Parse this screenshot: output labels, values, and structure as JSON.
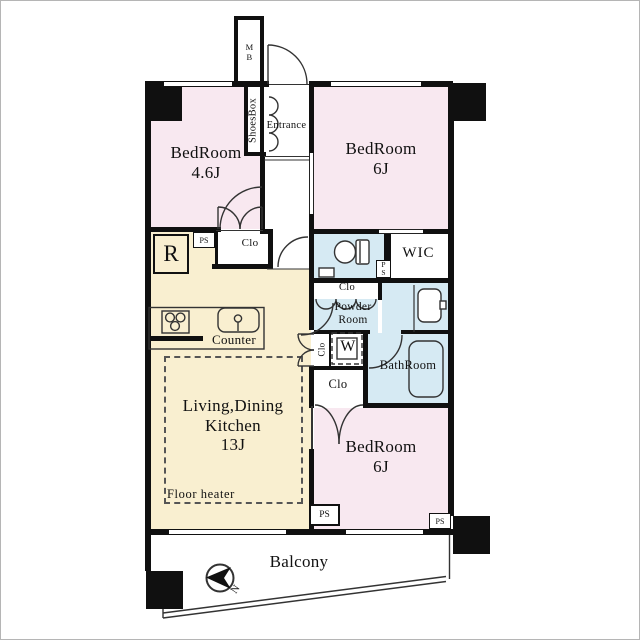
{
  "labels": {
    "bedroom46_name": "BedRoom",
    "bedroom46_size": "4.6J",
    "bedroom6top_name": "BedRoom",
    "bedroom6top_size": "6J",
    "bedroom6bottom_name": "BedRoom",
    "bedroom6bottom_size": "6J",
    "ldk_line1": "Living,Dining",
    "ldk_line2": "Kitchen",
    "ldk_line3": "13J",
    "floor_heater": "Floor heater",
    "counter": "Counter",
    "balcony": "Balcony",
    "entrance": "Entrance",
    "shoes_box": "ShoesBox",
    "meter_box": "MB",
    "wic": "WIC",
    "powder_room": "Powder Room",
    "bathroom": "BathRoom",
    "refrigerator": "R",
    "washer": "W",
    "closet": "Clo",
    "pipe_shaft": "PS",
    "north": "N"
  },
  "colors": {
    "bedroom": "#f8e8f0",
    "wet_area": "#d6eaf3",
    "ldk": "#f9efd0",
    "wall": "#101010"
  }
}
